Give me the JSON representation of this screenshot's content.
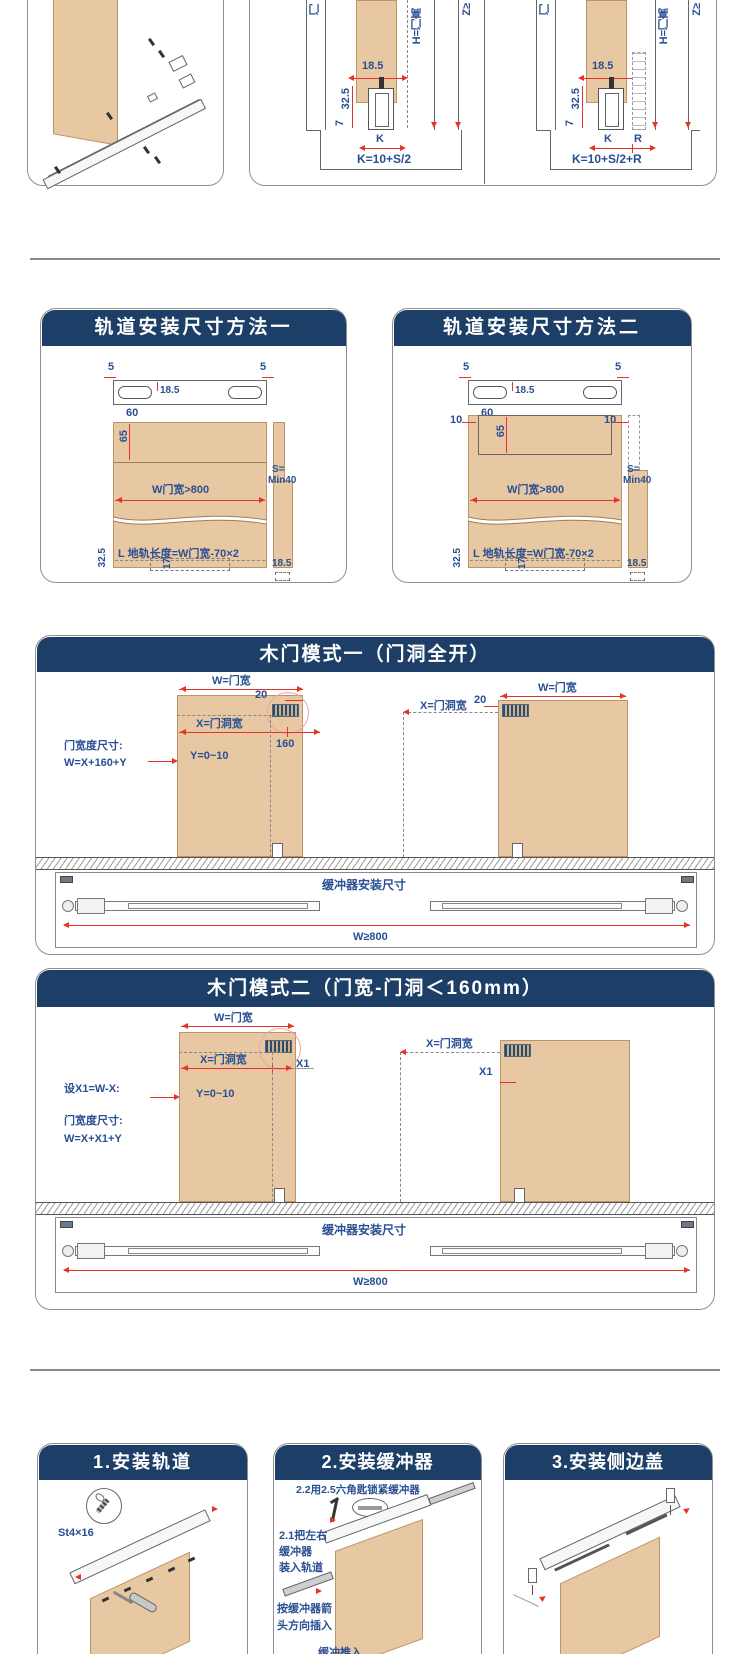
{
  "top": {
    "b": {
      "d185": "18.5",
      "d325": "32.5",
      "d7": "7",
      "k": "K",
      "formula": "K=10+S/2",
      "lab_door": "门",
      "lab_h": "H=门高",
      "lab_z": "Z≥"
    },
    "c": {
      "d185": "18.5",
      "d325": "32.5",
      "d7": "7",
      "k": "K",
      "r": "R",
      "formula": "K=10+S/2+R",
      "lab_door": "门",
      "lab_h": "H=门高",
      "lab_z": "Z≥"
    }
  },
  "m1": {
    "title": "轨道安装尺寸方法一",
    "d5": "5",
    "d185": "18.5",
    "d60": "60",
    "d65": "65",
    "w_label": "W门宽>800",
    "s1": "S=",
    "s2": "Min40",
    "l_label": "L 地轨长度=W门宽-70×2",
    "d17": "17",
    "d325": "32.5",
    "d185b": "18.5"
  },
  "m2": {
    "title": "轨道安装尺寸方法二",
    "d5": "5",
    "d185": "18.5",
    "d60": "60",
    "d10": "10",
    "d65": "65",
    "w_label": "W门宽>800",
    "s1": "S=",
    "s2": "Min40",
    "l_label": "L 地轨长度=W门宽-70×2",
    "d17": "17",
    "d325": "32.5",
    "d185b": "18.5"
  },
  "mode1": {
    "title": "木门模式一（门洞全开）",
    "w": "W=门宽",
    "d20": "20",
    "x": "X=门洞宽",
    "d160": "160",
    "spec1": "门宽度尺寸:",
    "spec2": "W=X+160+Y",
    "y": "Y=0~10",
    "buf": "缓冲器安装尺寸",
    "w800": "W≥800"
  },
  "mode2": {
    "title": "木门模式二（门宽-门洞＜160mm）",
    "w": "W=门宽",
    "x": "X=门洞宽",
    "x1": "X1",
    "set_label": "设X1=W-X:",
    "y": "Y=0~10",
    "spec1": "门宽度尺寸:",
    "spec2": "W=X+X1+Y",
    "buf": "缓冲器安装尺寸",
    "w800": "W≥800"
  },
  "steps": {
    "s1": {
      "title": "1.安装轨道",
      "screw": "St4×16"
    },
    "s2": {
      "title": "2.安装缓冲器",
      "tip22": "2.2用2.5六角匙锁紧缓冲器",
      "t21a": "2.1把左右",
      "t21b": "缓冲器",
      "t21c": "装入轨道",
      "ta1": "按缓冲器箭",
      "ta2": "头方向插入",
      "partial": "缓冲推入"
    },
    "s3": {
      "title": "3.安装侧边盖"
    }
  },
  "colors": {
    "navy": "#1d3e66",
    "blue": "#2a4f93",
    "red": "#e63327",
    "wood": "#e7c8a2"
  }
}
